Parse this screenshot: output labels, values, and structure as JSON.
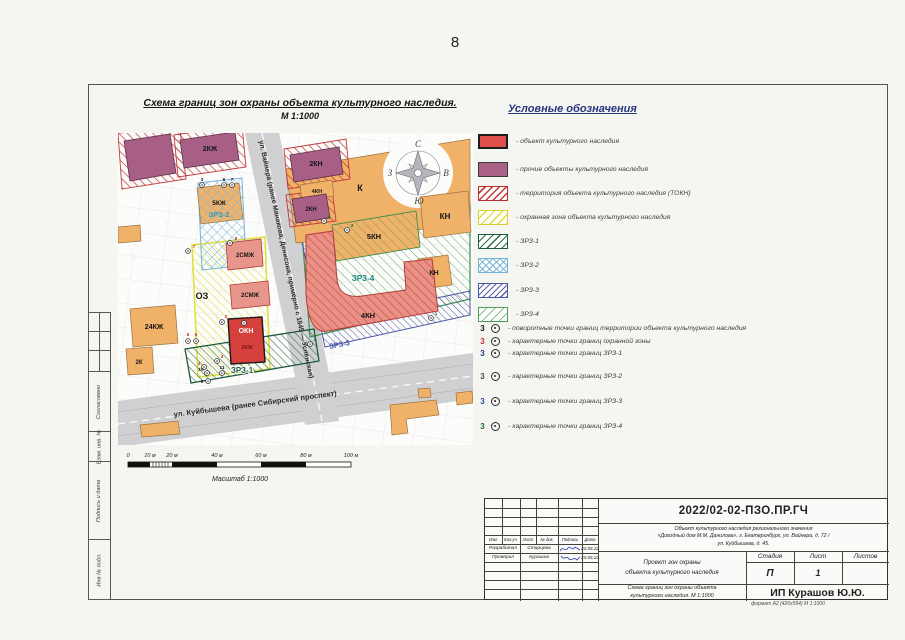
{
  "page": {
    "number": "8",
    "format_note": "формат А2 (420х594)  М 1:1000"
  },
  "map": {
    "title": "Схема границ зон охраны объекта культурного наследия.",
    "scale_note": "М 1:1000",
    "compass": {
      "n": "С",
      "s": "Ю",
      "e": "В",
      "w": "З"
    },
    "streets": {
      "vaynera": "ул. Вайнера (ранее Манакова, Денисова, примерно с 1845 — Успенская)",
      "kuybysheva": "ул. Куйбышева (ранее Сибирский проспект)"
    },
    "labels": {
      "b_2kzh": "2КЖ",
      "b_2kn1": "2КН",
      "b_4kn_top": "4КН",
      "b_2kn2": "2КН",
      "b_k": "К",
      "b_kn_right": "КН",
      "b_5kn": "5КН",
      "b_kn_mid": "КН",
      "b_4kn_big": "4КН",
      "z_zrz4": "ЗРЗ-4",
      "z_zrz3": "ЗРЗ-3",
      "z_zrz2": "ЗРЗ-2",
      "z_zrz1": "ЗРЗ-1",
      "b_5kzh": "5КЖ",
      "b_2smzh1": "2СМЖ",
      "b_2smzh2": "2СМЖ",
      "z_oz": "ОЗ",
      "b_okn": "ОКН",
      "b_okn_sub": "2КЖ",
      "b_24kzh": "24КЖ",
      "b_2k": "2К"
    },
    "points": [
      "7",
      "8",
      "2",
      "1",
      "5",
      "6",
      "3",
      "4",
      "10",
      "9",
      "11",
      "4",
      "1",
      "2",
      "6",
      "7",
      "3",
      "3"
    ],
    "scalebar": {
      "t0": "0",
      "t10": "10 м",
      "t20": "20 м",
      "t40": "40 м",
      "t60": "60 м",
      "t80": "80 м",
      "t100": "100 м",
      "caption": "Масштаб 1:1000"
    }
  },
  "legend": {
    "title": "Условные обозначения",
    "items": [
      {
        "label": "- объект культурного наследия",
        "color": "#dd4f4b"
      },
      {
        "label": "- прочие объекты  культурного наследия",
        "color": "#aa6287"
      },
      {
        "label": "- территория объекта культурного наследия (ТОКН)",
        "color": "#c23a3a"
      },
      {
        "label": "- охранная зона объекта культурного наследия",
        "color": "#e0dc3c"
      },
      {
        "label": "- ЗРЗ-1",
        "color": "#2c6e4f"
      },
      {
        "label": "- ЗРЗ-2",
        "color": "#7ab8dc"
      },
      {
        "label": "- ЗРЗ-3",
        "color": "#5560ae"
      },
      {
        "label": "- ЗРЗ-4",
        "color": "#57a35f"
      }
    ],
    "points": [
      {
        "num": "3",
        "label": "- поворотные  точки границ территории объекта культурного наследия",
        "color": "#1a1a1a"
      },
      {
        "num": "3",
        "label": "- характерные  точки границ охранной зоны",
        "color": "#c22f2f"
      },
      {
        "num": "3",
        "label": "- характерные  точки границ ЗРЗ-1",
        "color": "#223c8c"
      },
      {
        "num": "3",
        "label": "- характерные  точки границ ЗРЗ-2",
        "color": "#4a4a4a"
      },
      {
        "num": "3",
        "label": "- характерные  точки границ ЗРЗ-3",
        "color": "#2b4ea0"
      },
      {
        "num": "3",
        "label": "- характерные  точки границ ЗРЗ-4",
        "color": "#1d6e2f"
      }
    ]
  },
  "titleblock": {
    "doc_number": "2022/02-02-ПЗО.ПР.ГЧ",
    "object_line1": "Объект культурного наследия регионального значения",
    "object_line2": "«Доходный дом М.М. Данилова», г. Екатеринбург, ул. Вайнера, д. 72 /",
    "object_line3": "ул. Куйбышева, д. 45.",
    "cols": {
      "izm": "Изм.",
      "koluch": "Кол.уч.",
      "list": "Лист",
      "ndok": "№ док.",
      "podpis": "Подпись",
      "data": "Дата"
    },
    "rows": [
      {
        "role": "Разработал",
        "name": "Старцева",
        "date": "23.05.22"
      },
      {
        "role": "Проверил",
        "name": "Курашов",
        "date": "23.05.22"
      }
    ],
    "project_line1": "Проект зон охраны",
    "project_line2": "объекта культурного наследия",
    "stage_label": "Стадия",
    "sheet_label": "Лист",
    "sheets_label": "Листов",
    "stage_value": "П",
    "sheet_value": "1",
    "drawing_line1": "Схема границ зон охраны объекта",
    "drawing_line2": "культурного наследия. М 1:1000",
    "company": "ИП Курашов Ю.Ю."
  },
  "frame": {
    "side_labels": [
      "Согласовано",
      "Взам. инв. №",
      "Подпись и дата",
      "Инв.№ подл."
    ]
  }
}
